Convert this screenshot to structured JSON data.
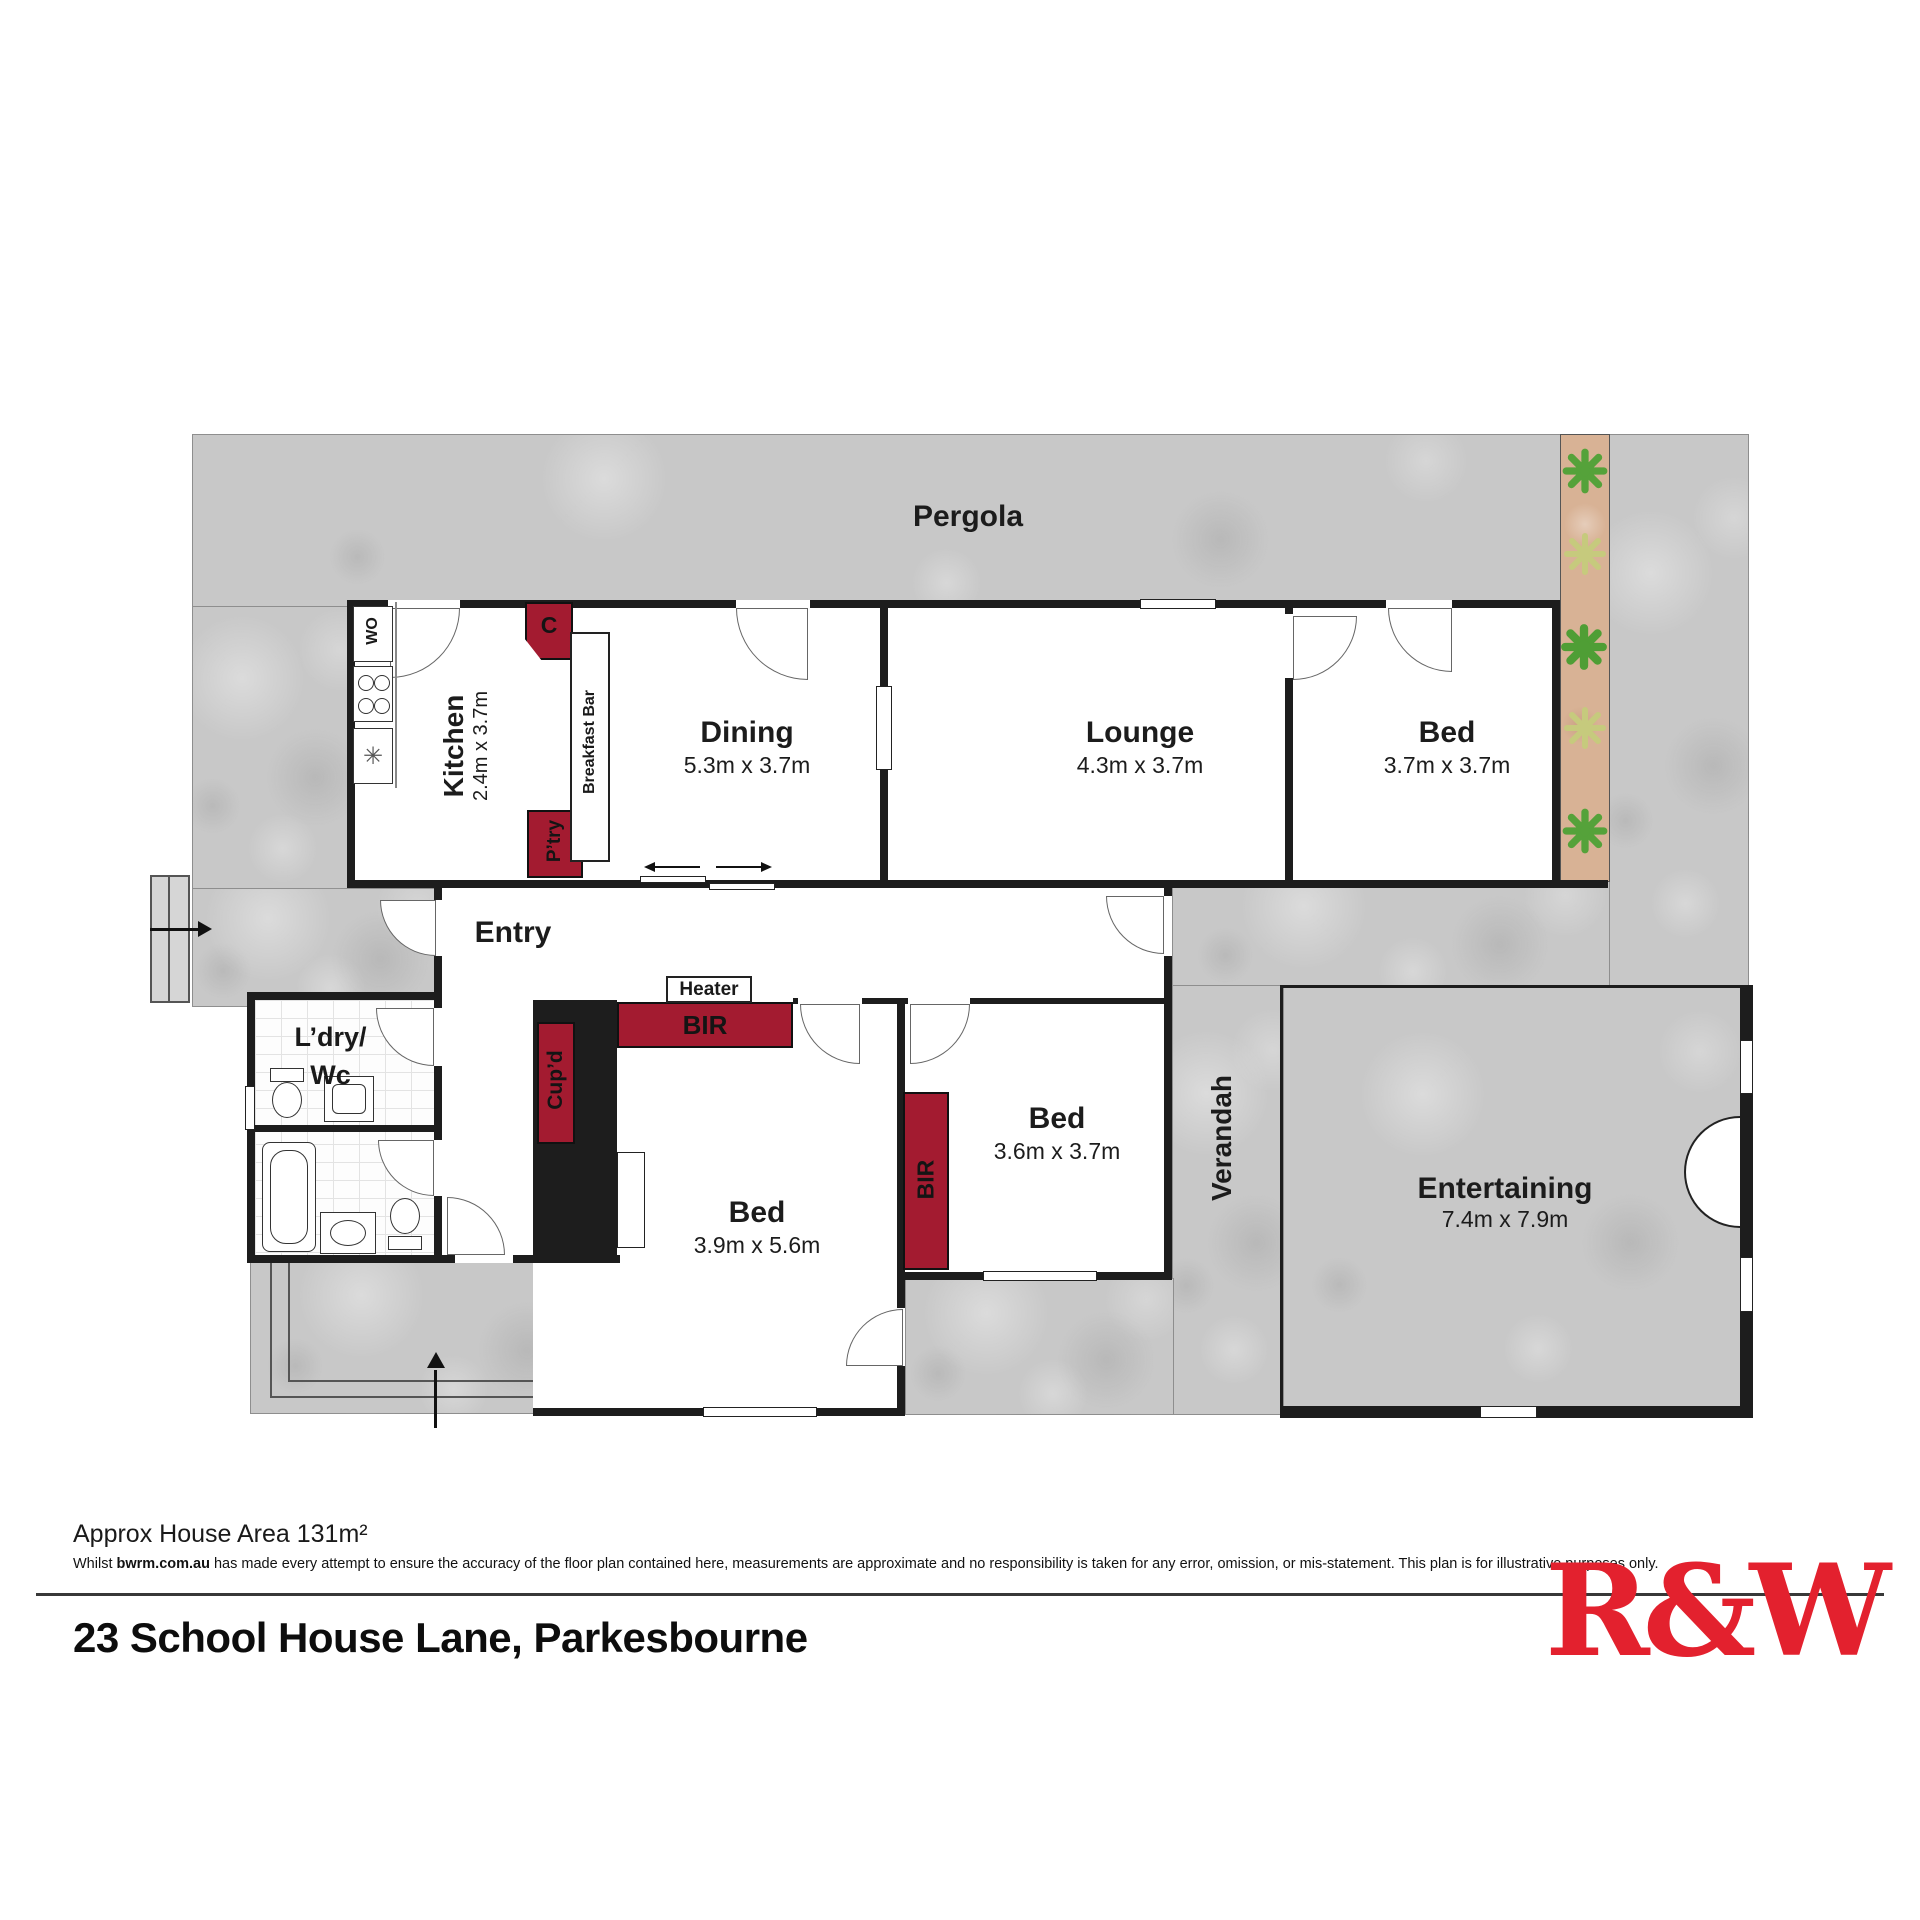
{
  "colors": {
    "accent_red": "#a31b30",
    "logo_red": "#e3212e",
    "wall_black": "#1d1d1d",
    "concrete_gray": "#c8c8c8",
    "deck_tan": "#d8b295"
  },
  "rooms": {
    "pergola": {
      "name": "Pergola"
    },
    "kitchen": {
      "name": "Kitchen",
      "dims": "2.4m x 3.7m"
    },
    "dining": {
      "name": "Dining",
      "dims": "5.3m x 3.7m"
    },
    "lounge": {
      "name": "Lounge",
      "dims": "4.3m x 3.7m"
    },
    "bed1": {
      "name": "Bed",
      "dims": "3.7m x 3.7m"
    },
    "entry": {
      "name": "Entry"
    },
    "laundry": {
      "line1": "L’dry/",
      "line2": "Wc"
    },
    "bed2": {
      "name": "Bed",
      "dims": "3.9m x 5.6m"
    },
    "bed3": {
      "name": "Bed",
      "dims": "3.6m x 3.7m"
    },
    "verandah": {
      "name": "Verandah"
    },
    "entertaining": {
      "name": "Entertaining",
      "dims": "7.4m x 7.9m"
    }
  },
  "features": {
    "wall_oven": "WO",
    "cupboard_c": "C",
    "breakfast_bar": "Breakfast Bar",
    "pantry": "P’try",
    "heater": "Heater",
    "bir_bed2": "BIR",
    "cupd_bed2": "Cup’d",
    "bir_bed3": "BIR"
  },
  "footer": {
    "area": "Approx House Area 131m²",
    "disclaimer_prefix": "Whilst ",
    "disclaimer_site": "bwrm.com.au",
    "disclaimer_rest": " has made every attempt to ensure the accuracy of the floor plan contained here, measurements are approximate and no responsibility is taken for any error, omission, or mis-statement. This plan is for illustrative purposes only.",
    "address": "23 School House Lane, Parkesbourne",
    "logo": "R&W"
  }
}
